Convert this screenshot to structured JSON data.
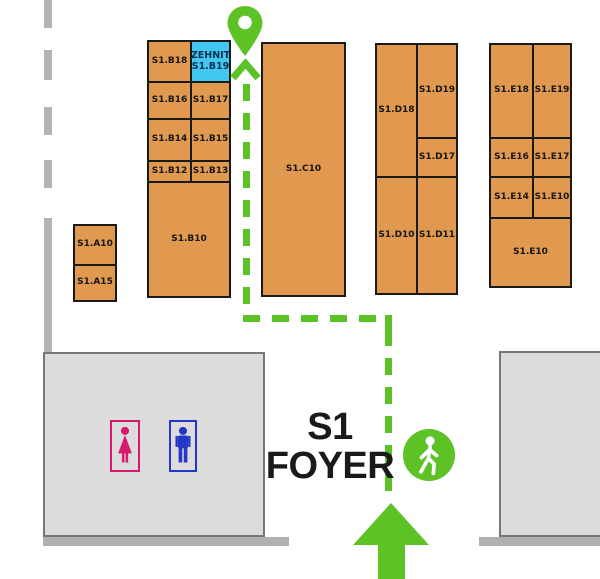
{
  "foyer": {
    "line1": "S1",
    "line2": "FOYER"
  },
  "highlight": {
    "exhibitor": "ZEHNIT",
    "booth": "S1.B19"
  },
  "booths": {
    "a10": "S1.A10",
    "a15": "S1.A15",
    "b18": "S1.B18",
    "b16": "S1.B16",
    "b17": "S1.B17",
    "b14": "S1.B14",
    "b15": "S1.B15",
    "b12": "S1.B12",
    "b13": "S1.B13",
    "b10": "S1.B10",
    "c10": "S1.C10",
    "d18": "S1.D18",
    "d19": "S1.D19",
    "d17": "S1.D17",
    "d10": "S1.D10",
    "d11": "S1.D11",
    "e18": "S1.E18",
    "e19": "S1.E19",
    "e16": "S1.E16",
    "e17": "S1.E17",
    "e14": "S1.E14",
    "e10_small": "S1.E10",
    "e10_large": "S1.E10"
  },
  "icons": {
    "destination_pin": "location-pin",
    "route_direction": "chevron-up-arrow",
    "entrance": "up-arrow",
    "pedestrian": "walking-person",
    "restroom_female": "female-figure",
    "restroom_male": "male-figure"
  },
  "colors": {
    "booth_fill": "#E0994F",
    "booth_border": "#1A1A1A",
    "highlight_fill": "#41C7F0",
    "highlight_text": "#0A3050",
    "route_green": "#5CC226",
    "building_fill": "#DCDCDC",
    "building_border": "#777777",
    "wall_gray": "#B3B3B3",
    "female_pink": "#D6186E",
    "male_blue": "#2438C8"
  }
}
